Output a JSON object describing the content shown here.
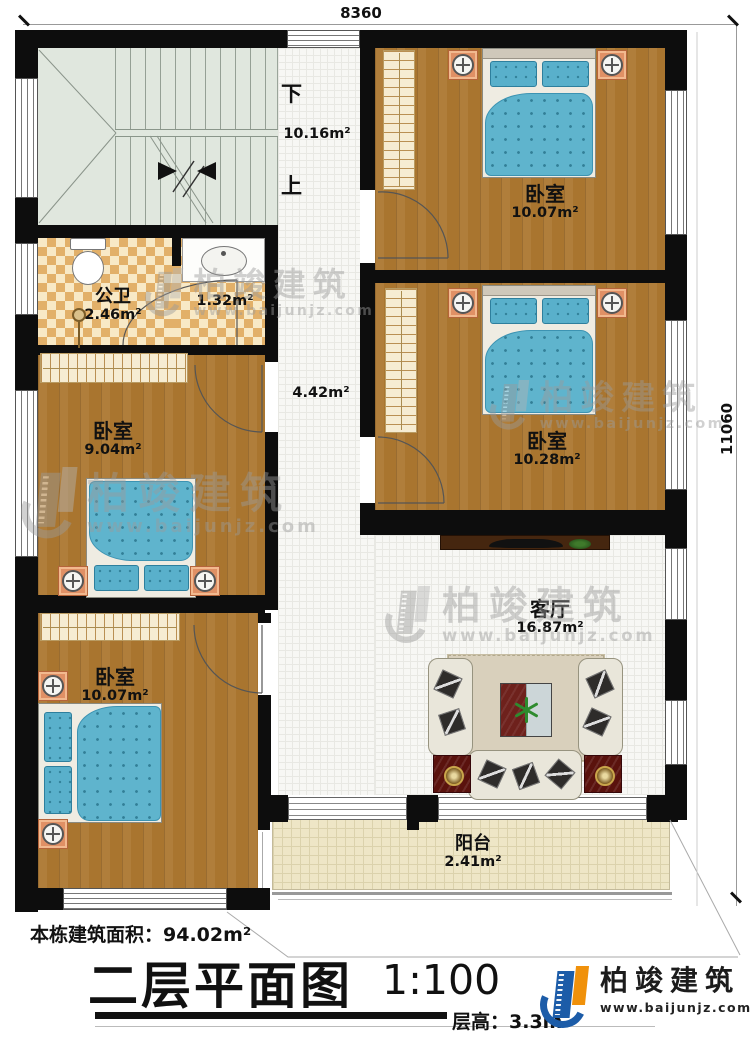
{
  "dimensions": {
    "width_top": "8360",
    "height_right": "11060"
  },
  "stairs": {
    "down_label": "下",
    "up_label": "上",
    "hall_area": "10.16m²"
  },
  "rooms": {
    "bedroom_top_right": {
      "name": "卧室",
      "area": "10.07m²"
    },
    "bedroom_mid_right": {
      "name": "卧室",
      "area": "10.28m²"
    },
    "bedroom_mid_left": {
      "name": "卧室",
      "area": "9.04m²"
    },
    "bedroom_bottom_left": {
      "name": "卧室",
      "area": "10.07m²"
    },
    "bathroom": {
      "name": "公卫",
      "area": "2.46m²"
    },
    "wash_area": {
      "area": "1.32m²"
    },
    "hallway": {
      "area": "4.42m²"
    },
    "living_room": {
      "name": "客厅",
      "area": "16.87m²"
    },
    "balcony": {
      "name": "阳台",
      "area": "2.41m²"
    }
  },
  "footer": {
    "building_area_label": "本栋建筑面积：94.02m²",
    "title": "二层平面图",
    "scale": "1:100",
    "floor_height_label": "层高：3.3m"
  },
  "brand": {
    "name": "柏竣建筑",
    "website": "www.baijunjz.com",
    "blue": "#1c5ca8",
    "orange": "#f0910b"
  },
  "watermark": {
    "name": "柏竣建筑",
    "website": "www.baijunjz.com"
  }
}
